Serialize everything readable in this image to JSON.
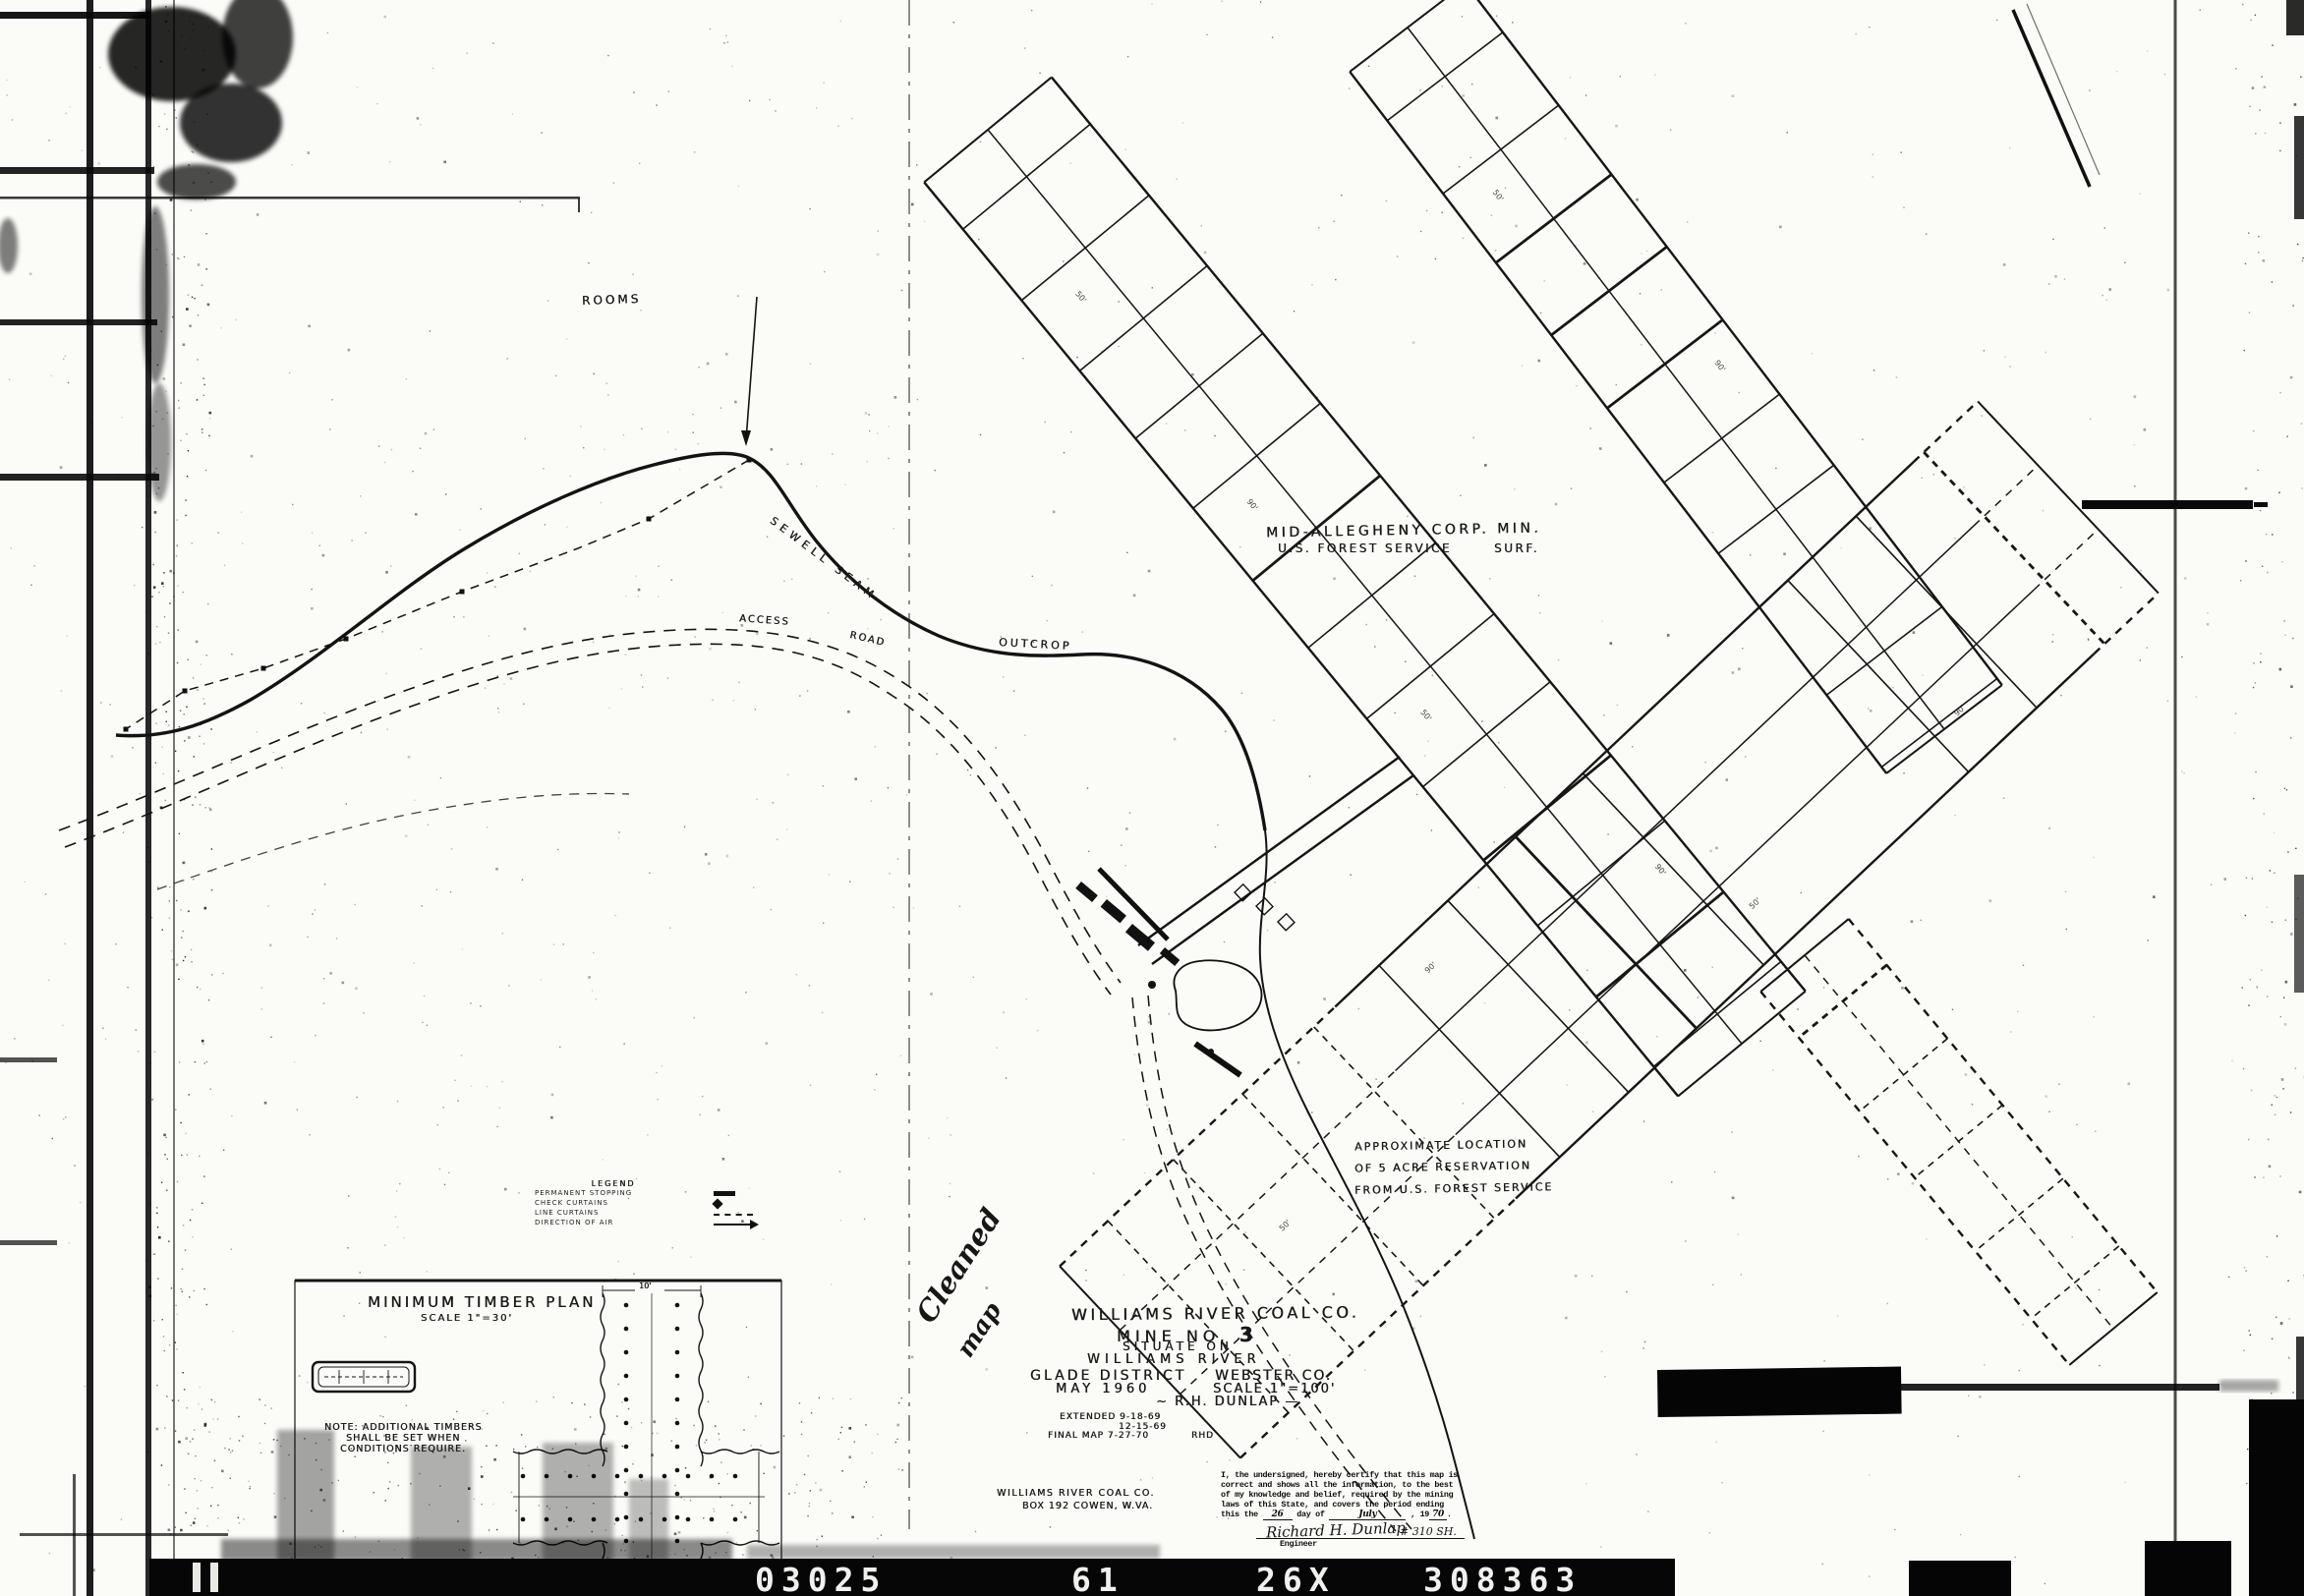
{
  "colors": {
    "paper": "#fbfbf8",
    "ink": "#151515",
    "footer_bar": "#060606"
  },
  "map_labels": {
    "rooms": "ROOMS",
    "seam": "SEWELL SEAM",
    "outcrop": "OUTCROP",
    "access_road_1": "ACCESS",
    "access_road_2": "ROAD",
    "tract_owner_line1": "MID-ALLEGHENY CORP. MIN.",
    "tract_owner_line2a": "U.S. FOREST SERVICE",
    "tract_owner_line2b": "SURF.",
    "reservation_line1": "APPROXIMATE LOCATION",
    "reservation_line2": "OF 5 ACRE RESERVATION",
    "reservation_line3": "FROM U.S. FOREST SERVICE",
    "handwritten_note_line1": "Cleaned",
    "handwritten_note_line2": "map"
  },
  "legend": {
    "title": "LEGEND",
    "items": [
      {
        "label": "PERMANENT STOPPING",
        "symbol": "solid-bar"
      },
      {
        "label": "CHECK CURTAINS",
        "symbol": "check-mark"
      },
      {
        "label": "LINE CURTAINS",
        "symbol": "dashed-line"
      },
      {
        "label": "DIRECTION OF AIR",
        "symbol": "arrow"
      }
    ]
  },
  "timber_plan": {
    "title": "MINIMUM TIMBER PLAN",
    "scale": "SCALE 1\"=30'",
    "note_lines": [
      "NOTE: ADDITIONAL TIMBERS",
      "SHALL BE SET WHEN",
      "CONDITIONS REQUIRE."
    ],
    "top_dimension": "10'"
  },
  "title_block": {
    "company": "WILLIAMS RIVER COAL CO.",
    "mine_label": "MINE NO.",
    "mine_number": "3",
    "situate": "SITUATE ON",
    "river": "WILLIAMS RIVER",
    "district": "GLADE DISTRICT",
    "county": "WEBSTER CO.",
    "date": "MAY 1960",
    "scale": "SCALE 1\"=100'",
    "engineer": "~ R.H. DUNLAP —",
    "revisions": [
      "EXTENDED  9-18-69",
      "12-15-69",
      "FINAL MAP 7-27-70",
      "RHD"
    ],
    "address_line1": "WILLIAMS RIVER COAL CO.",
    "address_line2": "BOX 192    COWEN, W.VA."
  },
  "certification": {
    "lines": [
      "I, the undersigned, hereby certify that this map is",
      "correct and shows all the information, to the best",
      "of my knowledge and belief, required by the mining",
      "laws of this State, and covers the period ending"
    ],
    "line5": {
      "prefix": "this the",
      "day": "26",
      "mid": "day of",
      "month": "July",
      "year_label": "19",
      "year": "70"
    },
    "signature": "Richard H. Dunlap",
    "license_no": "# 310 SH.",
    "role": "Engineer"
  },
  "footer_bar": {
    "codes": [
      "03025",
      "61",
      "26X",
      "308363"
    ]
  },
  "survey_dimensions": [
    "50'",
    "90'"
  ]
}
